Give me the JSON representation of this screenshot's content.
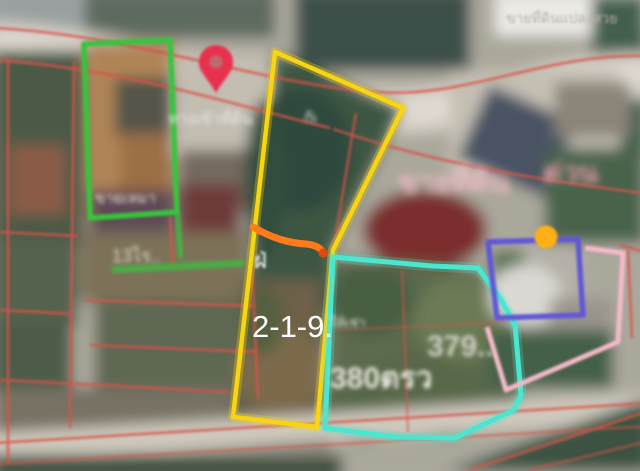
{
  "meta": {
    "view": "satellite-listing-map",
    "description": "blurred aerial photo with land parcel overlays"
  },
  "colors": {
    "yellow_parcel": "#f8d512",
    "cyan_parcel": "#4ae6cf",
    "green_parcel": "#38c43c",
    "purple_parcel": "#6156d6",
    "pink_parcel": "#f7bacb",
    "orange_highlight": "#ff7a1c",
    "orange_highlight_tip": "#e0480f",
    "orange_marker": "#ffb012",
    "pin_red": "#e8304d",
    "pin_inner": "#bb6b72",
    "red_boundary": "#d9534a"
  },
  "labels": {
    "yellow_area": "2-1-9."
  },
  "blurred_labels": {
    "cyan_area_right": "379..",
    "cyan_area_left": "380ตรว",
    "cyan_note": "ให้เช่า",
    "left_area_note": "13ไร..",
    "green_parcel_note": "ขายเหมา",
    "access_road_note": "ทางเข้าที่ดิน",
    "house_no": "ก้เ",
    "side_glyph": "ฝ่",
    "watermark": "ขายที่ดินแปลงสวย",
    "promo_left": "ขายที่ดิน",
    "promo_right": "ด่วน"
  }
}
